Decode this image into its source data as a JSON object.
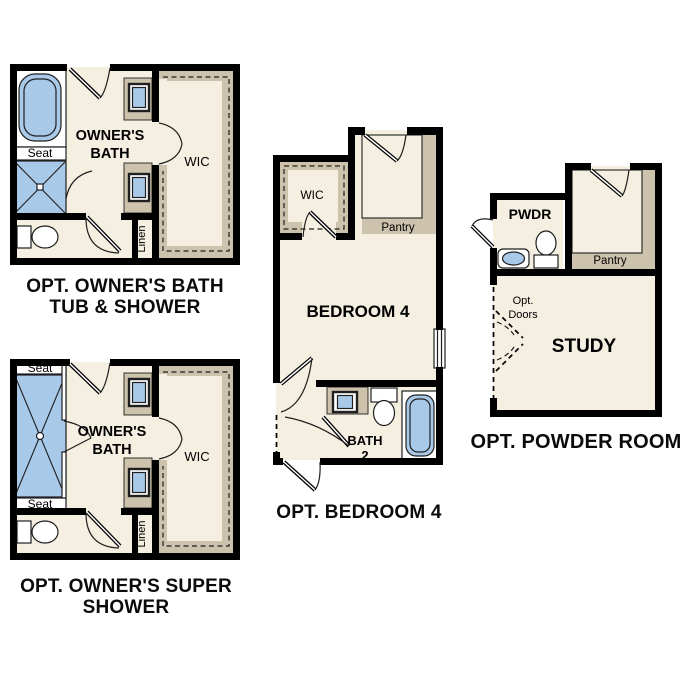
{
  "colors": {
    "wall": "#000000",
    "floor": "#f5efe1",
    "tan": "#cdc3ad",
    "blue": "#a9c9e9",
    "ink": "#1f1f1f"
  },
  "plans": {
    "owners_bath": {
      "caption_line1": "OPT. OWNER'S BATH",
      "caption_line2": "TUB & SHOWER",
      "labels": {
        "room_line1": "OWNER'S",
        "room_line2": "BATH",
        "wic": "WIC",
        "seat": "Seat",
        "linen": "Linen"
      }
    },
    "super_shower": {
      "caption_line1": "OPT. OWNER'S SUPER",
      "caption_line2": "SHOWER",
      "labels": {
        "room_line1": "OWNER'S",
        "room_line2": "BATH",
        "wic": "WIC",
        "seat_top": "Seat",
        "seat_bottom": "Seat",
        "linen": "Linen"
      }
    },
    "bedroom4": {
      "caption": "OPT. BEDROOM 4",
      "labels": {
        "room": "BEDROOM 4",
        "wic": "WIC",
        "pantry": "Pantry",
        "bath_line1": "BATH",
        "bath_line2": "2"
      }
    },
    "powder": {
      "caption": "OPT. POWDER ROOM",
      "labels": {
        "pwdr": "PWDR",
        "pantry": "Pantry",
        "study": "STUDY",
        "opt_doors_line1": "Opt.",
        "opt_doors_line2": "Doors"
      }
    }
  }
}
